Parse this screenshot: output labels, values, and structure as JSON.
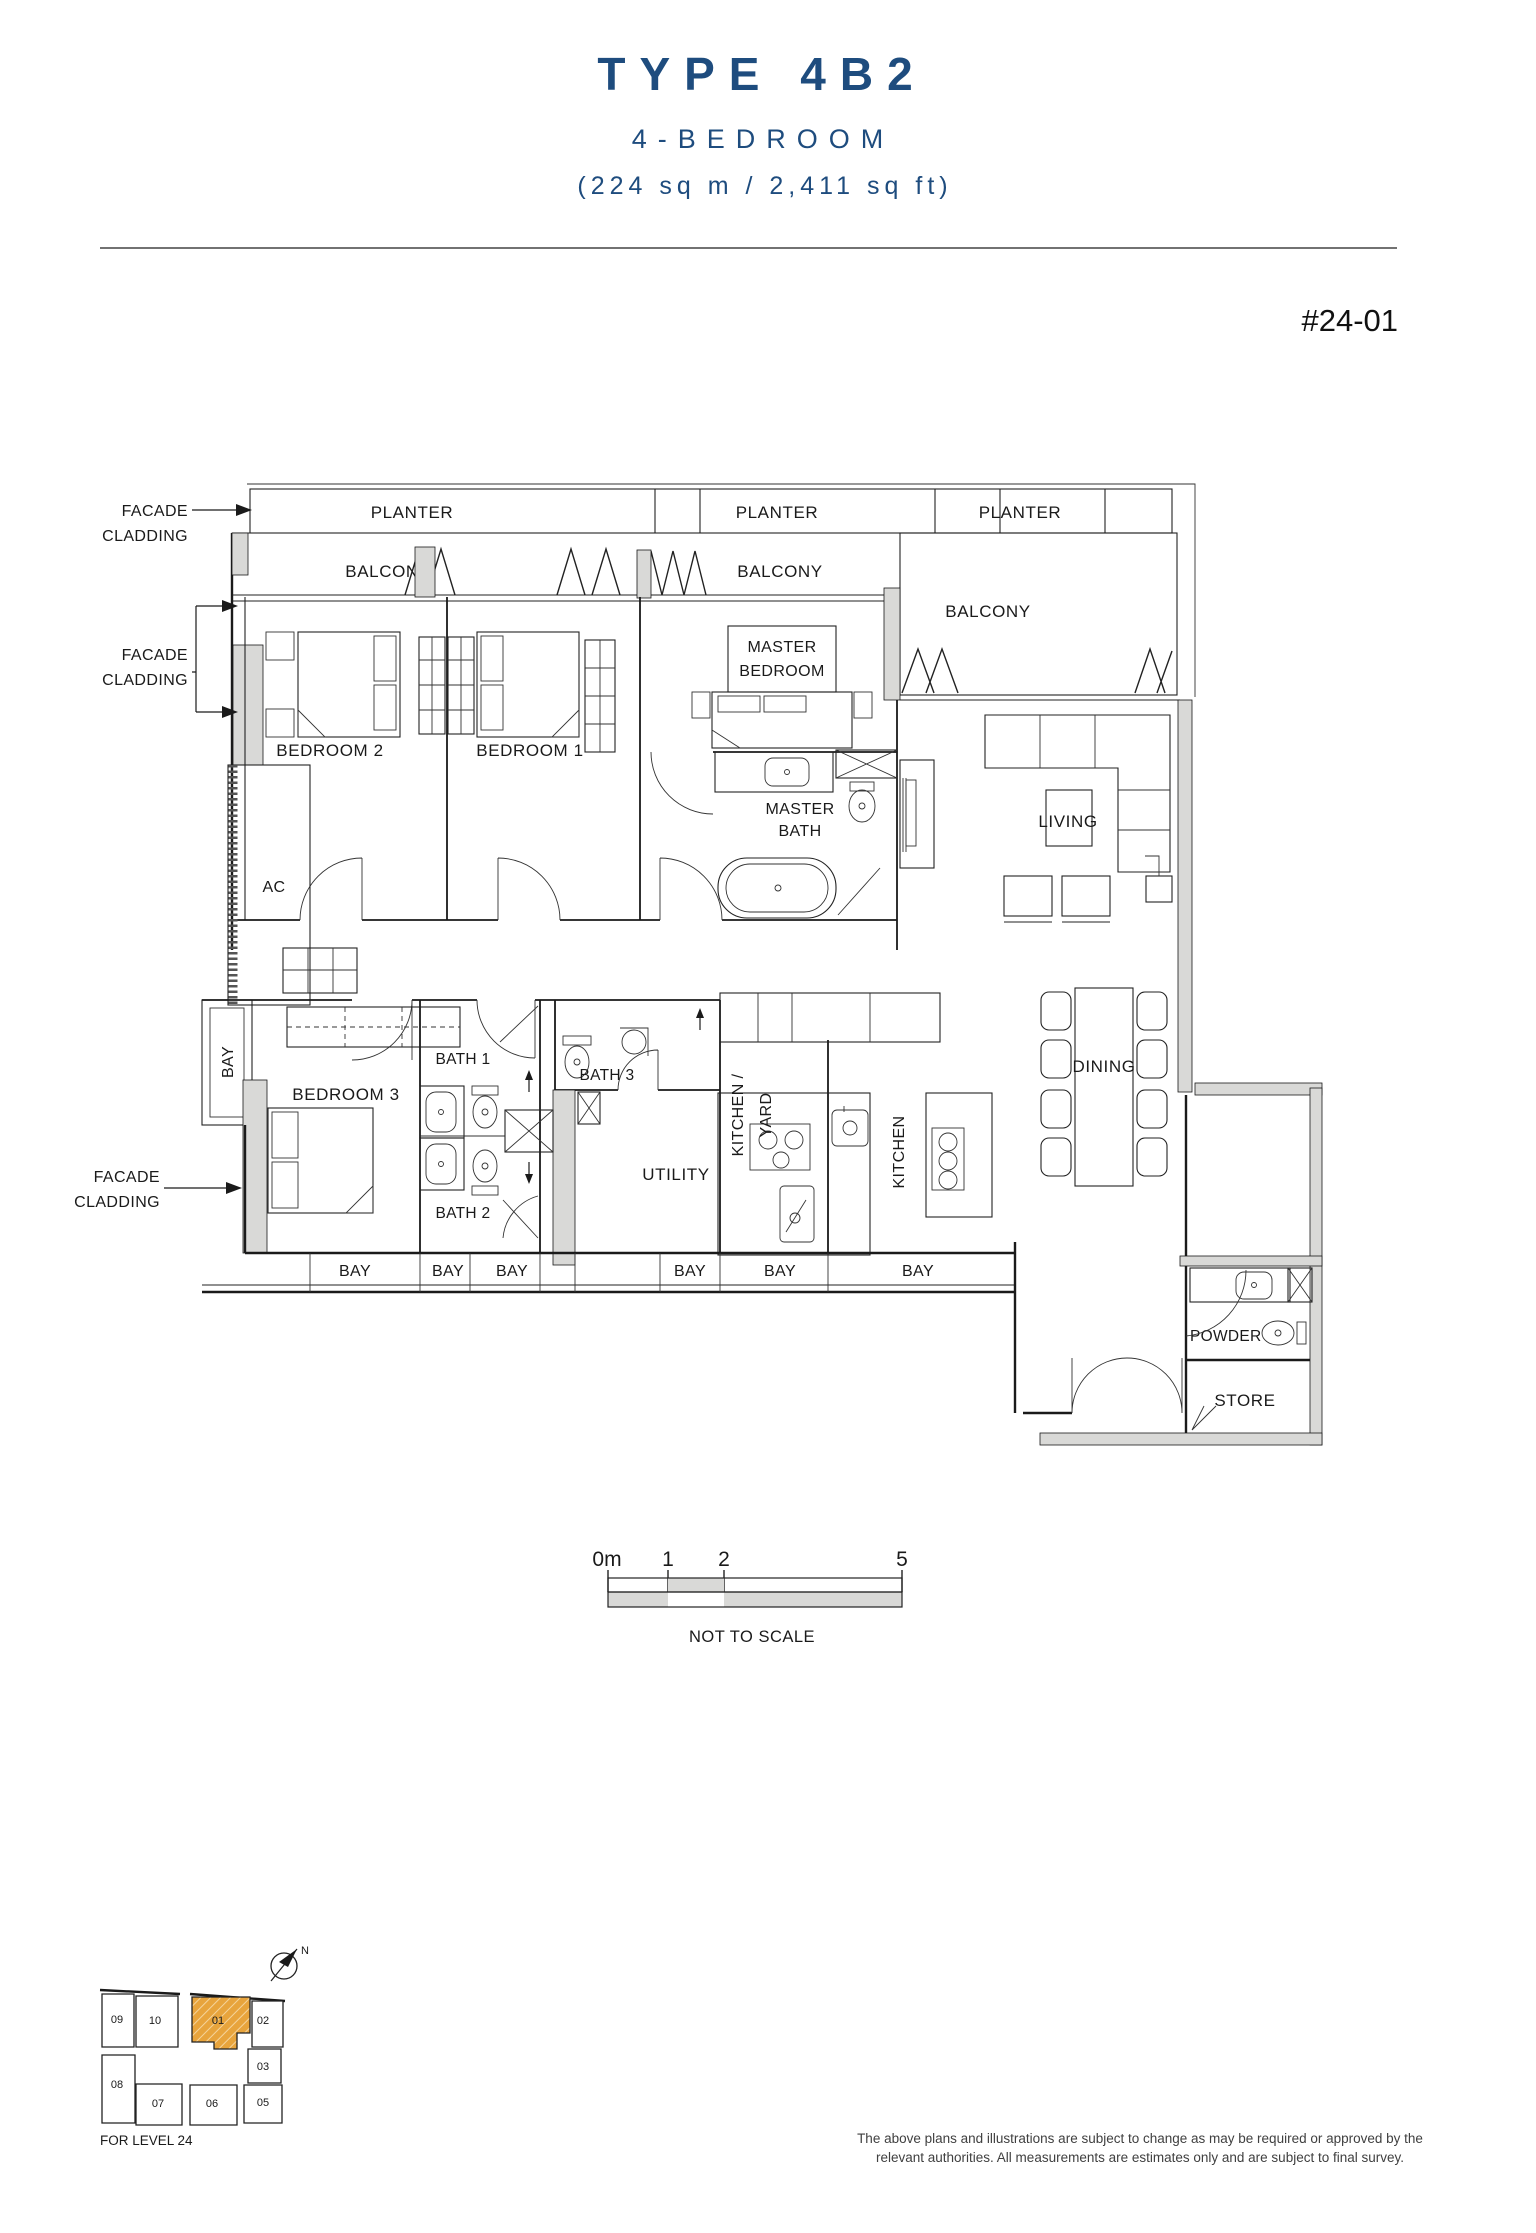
{
  "header": {
    "title": "TYPE 4B2",
    "subtitle": "4-BEDROOM",
    "area": "(224 sq m / 2,411 sq ft)",
    "unit_number": "#24-01",
    "title_color": "#1e4c7e"
  },
  "plan": {
    "labels": {
      "planter": "PLANTER",
      "balcony": "BALCONY",
      "bedroom1": "BEDROOM 1",
      "bedroom2": "BEDROOM 2",
      "bedroom3": "BEDROOM 3",
      "master_l1": "MASTER",
      "master_l2": "BEDROOM",
      "masterbath_l1": "MASTER",
      "masterbath_l2": "BATH",
      "living": "LIVING",
      "dining": "DINING",
      "ac": "AC",
      "bay": "BAY",
      "bath1": "BATH 1",
      "bath2": "BATH 2",
      "bath3": "BATH 3",
      "utility": "UTILITY",
      "kitchen_yard_l1": "KITCHEN /",
      "kitchen_yard_l2": "YARD",
      "kitchen": "KITCHEN",
      "powder": "POWDER",
      "store": "STORE",
      "facade_l1": "FACADE",
      "facade_l2": "CLADDING"
    },
    "wall_grey": "#d9d9d7"
  },
  "scale_bar": {
    "tick_0": "0m",
    "tick_1": "1",
    "tick_2": "2",
    "tick_5": "5",
    "note": "NOT TO SCALE"
  },
  "site_plan": {
    "level_note": "FOR LEVEL 24",
    "north": "N",
    "highlight_color": "#e8a43c",
    "highlighted_unit": "01",
    "units": [
      {
        "label": "09"
      },
      {
        "label": "10"
      },
      {
        "label": "01"
      },
      {
        "label": "02"
      },
      {
        "label": "03"
      },
      {
        "label": "05"
      },
      {
        "label": "06"
      },
      {
        "label": "07"
      },
      {
        "label": "08"
      }
    ]
  },
  "footer": {
    "disclaimer_l1": "The above plans and illustrations are subject to change as may be required or approved by the",
    "disclaimer_l2": "relevant authorities. All measurements are estimates only and are subject to final survey."
  }
}
